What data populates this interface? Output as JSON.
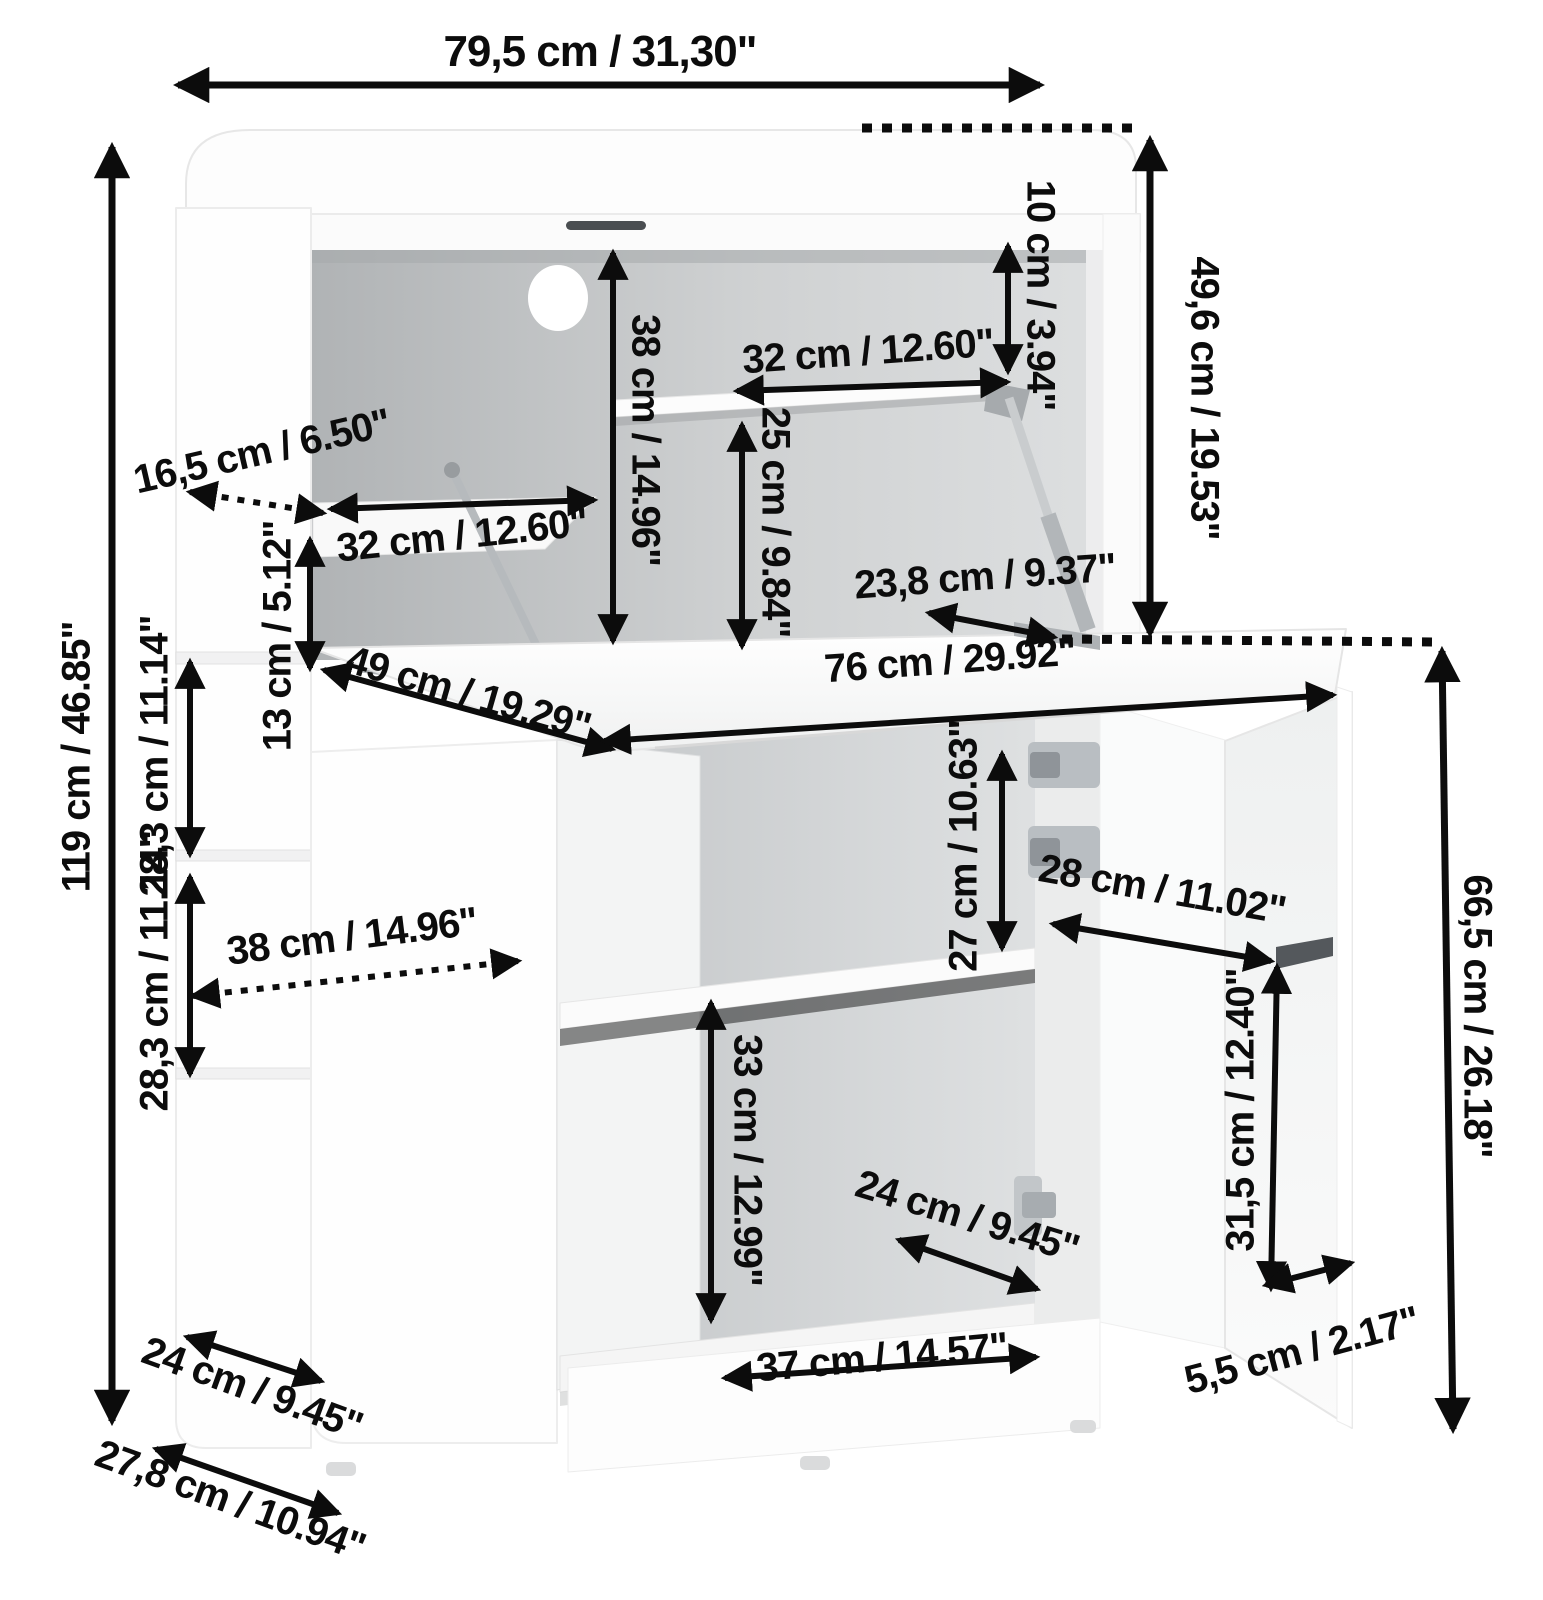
{
  "diagram": {
    "type": "furniture-dimension-drawing",
    "subject": "fold-down desk cabinet with hutch, open flap and open door",
    "units": "cm / inch",
    "line_color": "#0c0c0c",
    "dimensions": {
      "total_width": "79,5 cm / 31,30\"",
      "hutch_height": "49,6 cm / 19.53\"",
      "top_gap": "10 cm / 3.94\"",
      "hutch_shelf_width": "32 cm / 12.60\"",
      "hutch_inner_height": "38 cm / 14.96\"",
      "under_shelf_height": "25 cm / 9.84\"",
      "side_shelf_depth_top": "16,5 cm / 6.50\"",
      "left_shelf_width": "32 cm / 12.60\"",
      "shelf_to_desk": "13 cm / 5.12\"",
      "desk_depth": "49 cm / 19.29\"",
      "strut_offset": "23,8 cm / 9.37\"",
      "desk_width": "76 cm / 29.92\"",
      "total_height": "119 cm / 46.85\"",
      "side_top_section": "28,3 cm / 11.14\"",
      "side_shelf_depth": "38 cm / 14.96\"",
      "side_bottom_section": "28,3 cm / 11.14\"",
      "compartment_height": "27 cm / 10.63\"",
      "door_width": "28 cm / 11.02\"",
      "front_height": "66,5 cm / 26.18\"",
      "door_inner_height": "31,5 cm / 12.40\"",
      "lower_compartment_height": "33 cm / 12.99\"",
      "inner_depth": "24 cm / 9.45\"",
      "side_depth": "24 cm / 9.45\"",
      "plinth_width": "37 cm / 14.57\"",
      "base_depth": "27,8 cm / 10.94\"",
      "door_edge_gap": "5,5 cm / 2.17\""
    }
  }
}
